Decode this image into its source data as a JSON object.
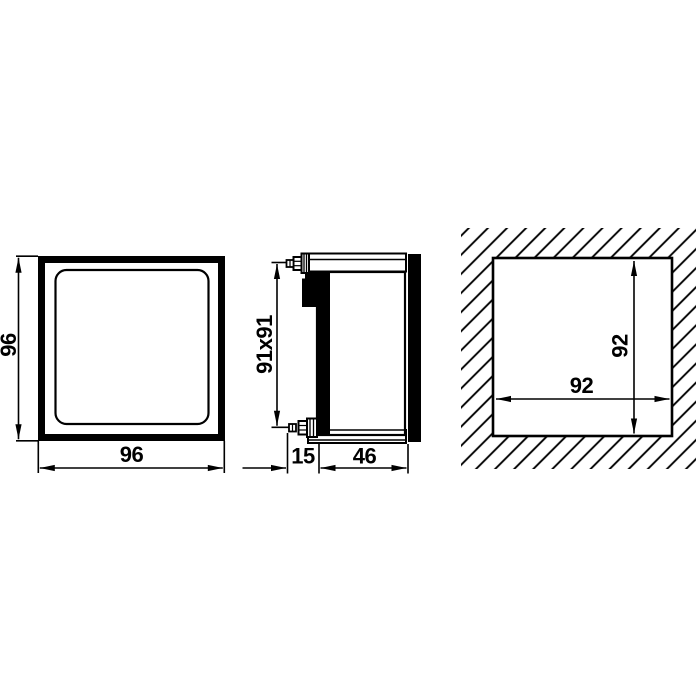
{
  "colors": {
    "ink": "#000000",
    "paper": "#ffffff"
  },
  "views": {
    "front": {
      "width_label": "96",
      "height_label": "96"
    },
    "side": {
      "case_section_label": "91x91",
      "clamp_depth_label": "15",
      "body_depth_label": "46"
    },
    "panel_cutout": {
      "width_label": "92",
      "height_label": "92"
    }
  }
}
